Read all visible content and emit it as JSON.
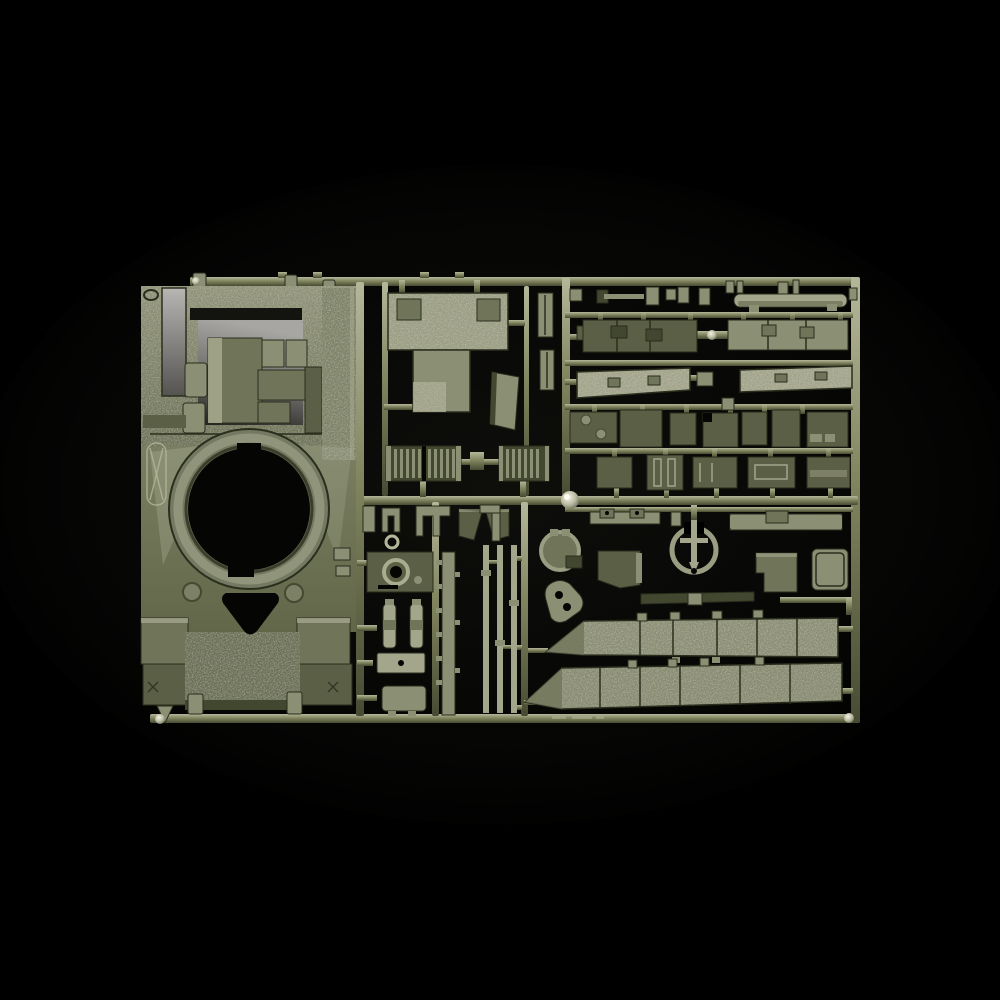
{
  "scene": {
    "subject": "model-kit-sprue-photograph",
    "plastic_color_family": "olive-green",
    "background_style": "studio-black"
  },
  "palette": {
    "bg": "#000000",
    "vig": "#0e0e0b",
    "rail_hi": "#b5b79b",
    "rail_mid": "#82865f",
    "rail_lo": "#474b33",
    "p_light": "#a4a68c",
    "p_sage": "#8b8f74",
    "p_mid": "#70755a",
    "p_olive": "#5a5f45",
    "p_dark": "#42472f",
    "edge": "#2a2e1d",
    "hole": "#050503",
    "recess_hi": "#a8a6a2",
    "recess_lo": "#22211e",
    "slot_hi": "#b8b6b2",
    "slot_lo": "#55534f",
    "sheen": "#bcbfa9",
    "glint": "#f4f2e2"
  },
  "parts": [
    "sprue-frame",
    "upper-hull-part",
    "turret-ring-opening",
    "engine-bay-recess",
    "glacis-plate",
    "turret-roof-part",
    "angled-plate-part",
    "radiator-grille-left",
    "radiator-grille-right",
    "small-fittings-row",
    "long-beam-part",
    "deck-panel-left",
    "deck-panel-right",
    "tread-plate-left",
    "tread-plate-right",
    "hatch-panel-row",
    "access-panel-row",
    "mudflap-pair",
    "headlamp-housing-part",
    "shock-absorber-pair",
    "ladder-rail-part",
    "rod-parts",
    "bracket-bar-part",
    "anchor-ring-part",
    "beam-with-box-part",
    "access-door-part",
    "stepped-panel-part",
    "dark-box-part",
    "round-hatch-part",
    "mantlet-shield-part",
    "dark-strip-part",
    "side-skirt-upper",
    "side-skirt-lower",
    "injection-gate-knob",
    "molded-marking"
  ]
}
